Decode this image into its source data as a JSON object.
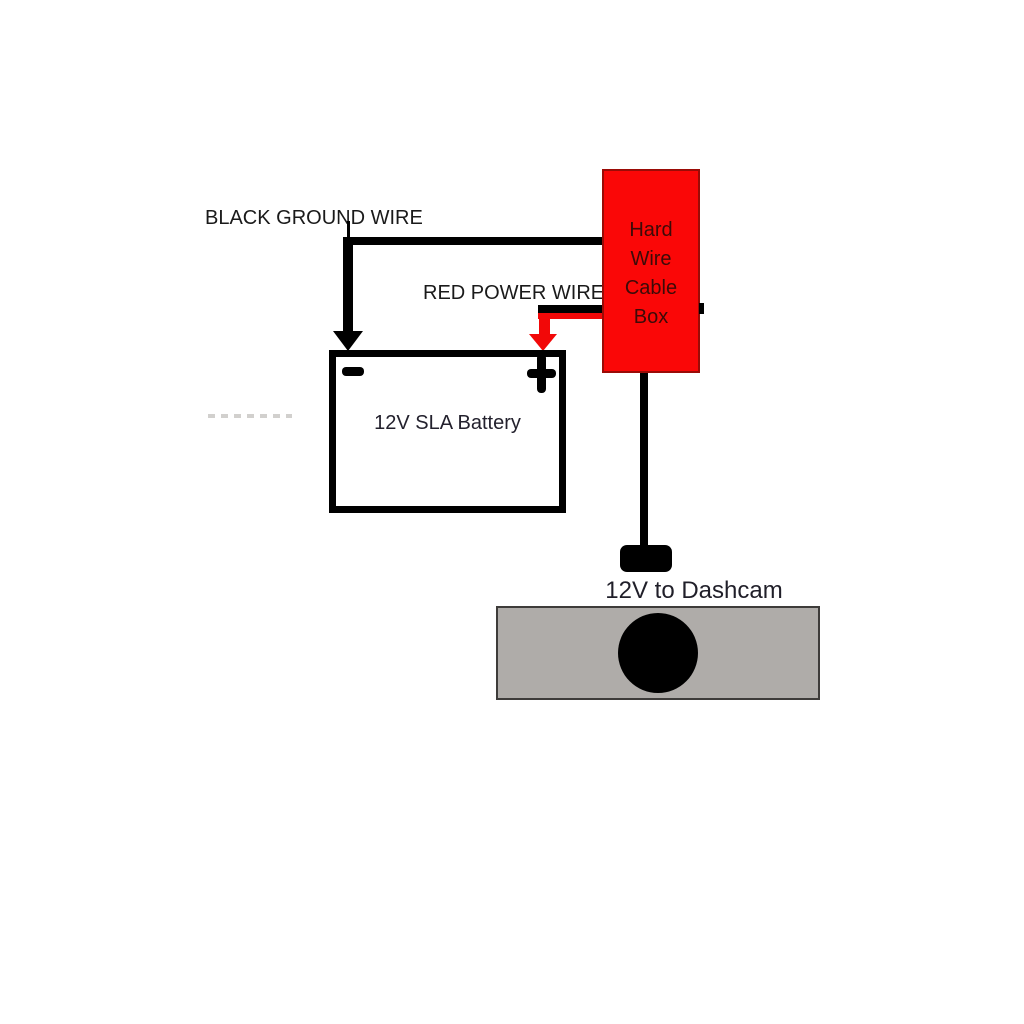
{
  "diagram": {
    "title_context": "dashcam hard wire installation diagram",
    "labels": {
      "ground_wire": "BLACK GROUND WIRE",
      "power_wire": "RED POWER WIRE",
      "hardwire_box": "Hard\nWire\nCable\nBox",
      "battery": "12V SLA Battery",
      "dashcam_plug": "12V to Dashcam"
    },
    "components": {
      "hardwire_box": {
        "fill": "#fa0707",
        "border": "#9b0b06",
        "text_color": "#3c0b08"
      },
      "battery": {
        "fill": "#ffffff",
        "border": "#000000",
        "negative_terminal": "-",
        "positive_terminal": "+"
      },
      "dashcam": {
        "body_fill": "#afaca9",
        "body_border": "#3e3c3a",
        "lens_color": "#000000"
      },
      "plug": {
        "fill": "#000000"
      }
    },
    "wires": {
      "ground_wire_color": "#000000",
      "power_wire_color": "#f20808",
      "dashcam_cable_color": "#000000"
    },
    "text_color": "#1a1a1a",
    "background": "#ffffff"
  }
}
